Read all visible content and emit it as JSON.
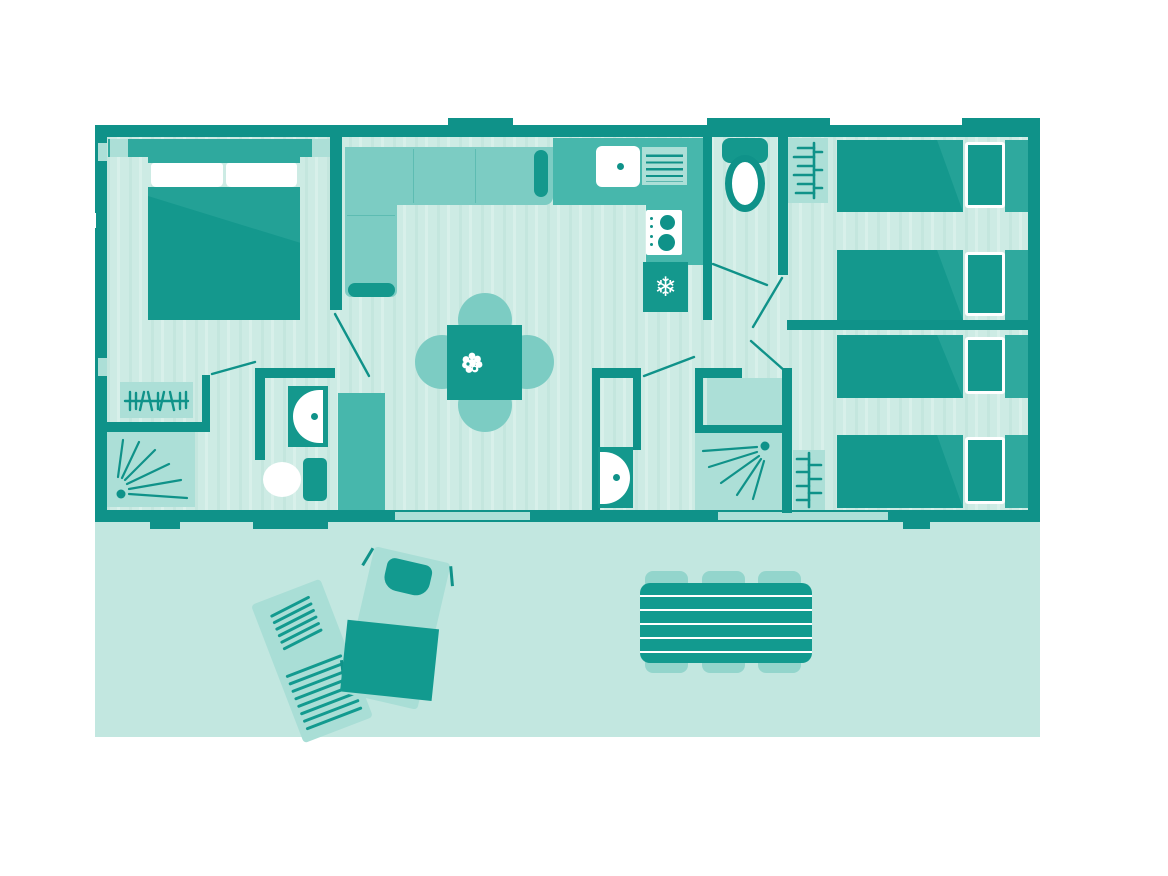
{
  "palette": {
    "wall": "#0F9289",
    "furnitureDark": "#14988D",
    "medium": "#2FA99E",
    "counter": "#47B7AC",
    "soft": "#7CCCC3",
    "panel": "#ACDFD7",
    "floorBase": "#CDEBE4",
    "floorStripeA": "#C4E6DE",
    "floorStripeB": "#D8F0EA",
    "terrace": "#C2E7E0",
    "lounger": "#A9DED6",
    "stool": "#93D5CC",
    "towel": "#129A8F",
    "white": "#FFFFFF"
  },
  "icons": {
    "snowflake": "❄"
  },
  "inventory": {
    "bedrooms": 3,
    "double_beds": 1,
    "single_beds": 4,
    "toilets": 2,
    "showers": 2,
    "washbasins": 3,
    "kitchen": [
      "sink",
      "drainer",
      "stove",
      "fridge"
    ],
    "living": [
      "corner-sofa",
      "dining-table",
      "four-chairs"
    ],
    "storage": [
      "wardrobe",
      "coat-rack",
      "towel-ladder",
      "cabinet"
    ],
    "terrace_furniture": {
      "sun_loungers": 2,
      "picnic_table_seats": 6
    }
  }
}
